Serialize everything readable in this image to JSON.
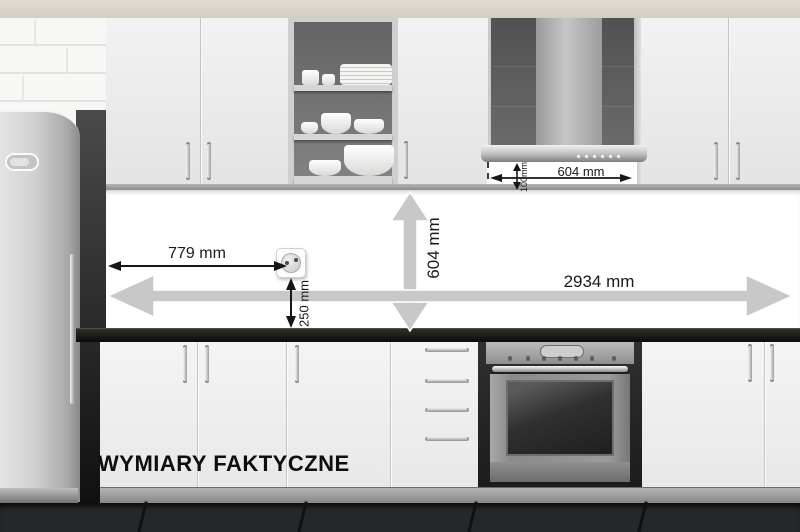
{
  "caption": "WYMIARY FAKTYCZNE",
  "dimensions": {
    "socket_from_left": "779 mm",
    "socket_above_counter": "250 mm",
    "splashback_height": "604 mm",
    "total_width": "2934 mm",
    "hood_width": "604 mm",
    "hood_clearance": "100mm"
  },
  "colors": {
    "dimension_arrow_gray": "#c8c8c8",
    "annotation_text": "#1a1a1a",
    "countertop": "#141414",
    "cabinet_front": "#efefef"
  }
}
